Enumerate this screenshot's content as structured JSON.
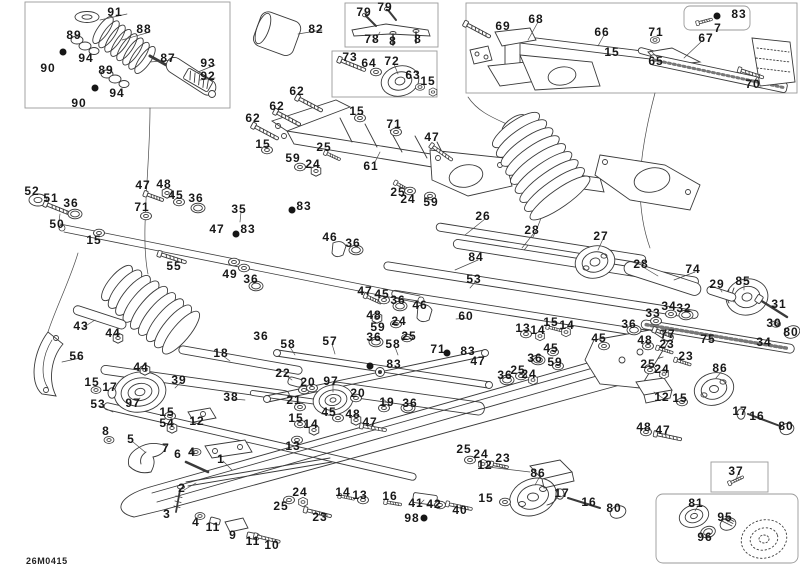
{
  "diagram": {
    "type": "exploded-parts-diagram",
    "drawing_number": "26M0415",
    "colors": {
      "background": "#ffffff",
      "line": "#3a3a3a",
      "box_border": "#9a9a9a",
      "label": "#181818"
    },
    "labels": [
      {
        "t": "91",
        "x": 115,
        "y": 12
      },
      {
        "t": "88",
        "x": 144,
        "y": 29
      },
      {
        "t": "89",
        "x": 74,
        "y": 35
      },
      {
        "t": "94",
        "x": 86,
        "y": 58
      },
      {
        "t": "90",
        "x": 48,
        "y": 68
      },
      {
        "t": "87",
        "x": 168,
        "y": 58
      },
      {
        "t": "93",
        "x": 208,
        "y": 63
      },
      {
        "t": "92",
        "x": 208,
        "y": 76
      },
      {
        "t": "89",
        "x": 106,
        "y": 70
      },
      {
        "t": "94",
        "x": 117,
        "y": 93
      },
      {
        "t": "90",
        "x": 79,
        "y": 103
      },
      {
        "t": "82",
        "x": 316,
        "y": 29
      },
      {
        "t": "79",
        "x": 364,
        "y": 12
      },
      {
        "t": "79",
        "x": 385,
        "y": 7
      },
      {
        "t": "78",
        "x": 372,
        "y": 39
      },
      {
        "t": "8",
        "x": 393,
        "y": 41
      },
      {
        "t": "8",
        "x": 418,
        "y": 39
      },
      {
        "t": "73",
        "x": 350,
        "y": 57
      },
      {
        "t": "64",
        "x": 369,
        "y": 63
      },
      {
        "t": "72",
        "x": 392,
        "y": 61
      },
      {
        "t": "63",
        "x": 413,
        "y": 75
      },
      {
        "t": "15",
        "x": 428,
        "y": 81
      },
      {
        "t": "62",
        "x": 297,
        "y": 91
      },
      {
        "t": "62",
        "x": 277,
        "y": 106
      },
      {
        "t": "62",
        "x": 253,
        "y": 118
      },
      {
        "t": "15",
        "x": 357,
        "y": 111
      },
      {
        "t": "15",
        "x": 263,
        "y": 144
      },
      {
        "t": "69",
        "x": 503,
        "y": 26
      },
      {
        "t": "68",
        "x": 536,
        "y": 19
      },
      {
        "t": "66",
        "x": 602,
        "y": 32
      },
      {
        "t": "71",
        "x": 656,
        "y": 32
      },
      {
        "t": "83",
        "x": 739,
        "y": 14
      },
      {
        "t": "7",
        "x": 718,
        "y": 28
      },
      {
        "t": "67",
        "x": 706,
        "y": 38
      },
      {
        "t": "15",
        "x": 612,
        "y": 52
      },
      {
        "t": "65",
        "x": 656,
        "y": 61
      },
      {
        "t": "70",
        "x": 753,
        "y": 84
      },
      {
        "t": "52",
        "x": 32,
        "y": 191
      },
      {
        "t": "51",
        "x": 51,
        "y": 198
      },
      {
        "t": "36",
        "x": 71,
        "y": 203
      },
      {
        "t": "50",
        "x": 57,
        "y": 224
      },
      {
        "t": "15",
        "x": 94,
        "y": 240
      },
      {
        "t": "47",
        "x": 143,
        "y": 185
      },
      {
        "t": "48",
        "x": 164,
        "y": 184
      },
      {
        "t": "45",
        "x": 176,
        "y": 195
      },
      {
        "t": "36",
        "x": 196,
        "y": 198
      },
      {
        "t": "71",
        "x": 142,
        "y": 207
      },
      {
        "t": "35",
        "x": 239,
        "y": 209
      },
      {
        "t": "47",
        "x": 217,
        "y": 229
      },
      {
        "t": "83",
        "x": 248,
        "y": 229
      },
      {
        "t": "55",
        "x": 174,
        "y": 266
      },
      {
        "t": "49",
        "x": 230,
        "y": 274
      },
      {
        "t": "36",
        "x": 251,
        "y": 279
      },
      {
        "t": "25",
        "x": 324,
        "y": 147
      },
      {
        "t": "59",
        "x": 293,
        "y": 158
      },
      {
        "t": "24",
        "x": 313,
        "y": 164
      },
      {
        "t": "61",
        "x": 371,
        "y": 166
      },
      {
        "t": "71",
        "x": 394,
        "y": 124
      },
      {
        "t": "47",
        "x": 432,
        "y": 137
      },
      {
        "t": "83",
        "x": 304,
        "y": 206
      },
      {
        "t": "25",
        "x": 398,
        "y": 192
      },
      {
        "t": "24",
        "x": 408,
        "y": 199
      },
      {
        "t": "59",
        "x": 431,
        "y": 202
      },
      {
        "t": "46",
        "x": 330,
        "y": 237
      },
      {
        "t": "36",
        "x": 353,
        "y": 243
      },
      {
        "t": "26",
        "x": 483,
        "y": 216
      },
      {
        "t": "28",
        "x": 532,
        "y": 230
      },
      {
        "t": "27",
        "x": 601,
        "y": 236
      },
      {
        "t": "84",
        "x": 476,
        "y": 257
      },
      {
        "t": "28",
        "x": 641,
        "y": 264
      },
      {
        "t": "74",
        "x": 693,
        "y": 269
      },
      {
        "t": "29",
        "x": 717,
        "y": 284
      },
      {
        "t": "85",
        "x": 743,
        "y": 281
      },
      {
        "t": "31",
        "x": 779,
        "y": 304
      },
      {
        "t": "30",
        "x": 774,
        "y": 323
      },
      {
        "t": "80",
        "x": 791,
        "y": 332
      },
      {
        "t": "34",
        "x": 669,
        "y": 306
      },
      {
        "t": "32",
        "x": 684,
        "y": 308
      },
      {
        "t": "33",
        "x": 653,
        "y": 313
      },
      {
        "t": "36",
        "x": 629,
        "y": 324
      },
      {
        "t": "77",
        "x": 668,
        "y": 334
      },
      {
        "t": "75",
        "x": 708,
        "y": 339
      },
      {
        "t": "34",
        "x": 764,
        "y": 342
      },
      {
        "t": "48",
        "x": 645,
        "y": 340
      },
      {
        "t": "23",
        "x": 667,
        "y": 344
      },
      {
        "t": "23",
        "x": 686,
        "y": 356
      },
      {
        "t": "25",
        "x": 648,
        "y": 364
      },
      {
        "t": "24",
        "x": 662,
        "y": 369
      },
      {
        "t": "86",
        "x": 720,
        "y": 368
      },
      {
        "t": "12",
        "x": 662,
        "y": 397
      },
      {
        "t": "15",
        "x": 680,
        "y": 398
      },
      {
        "t": "17",
        "x": 740,
        "y": 411
      },
      {
        "t": "16",
        "x": 757,
        "y": 416
      },
      {
        "t": "80",
        "x": 786,
        "y": 426
      },
      {
        "t": "48",
        "x": 644,
        "y": 427
      },
      {
        "t": "47",
        "x": 663,
        "y": 430
      },
      {
        "t": "53",
        "x": 474,
        "y": 279
      },
      {
        "t": "47",
        "x": 365,
        "y": 291
      },
      {
        "t": "45",
        "x": 382,
        "y": 294
      },
      {
        "t": "36",
        "x": 398,
        "y": 300
      },
      {
        "t": "46",
        "x": 420,
        "y": 305
      },
      {
        "t": "60",
        "x": 466,
        "y": 316
      },
      {
        "t": "48",
        "x": 374,
        "y": 315
      },
      {
        "t": "24",
        "x": 399,
        "y": 321
      },
      {
        "t": "59",
        "x": 378,
        "y": 327
      },
      {
        "t": "25",
        "x": 409,
        "y": 336
      },
      {
        "t": "36",
        "x": 261,
        "y": 336
      },
      {
        "t": "58",
        "x": 288,
        "y": 344
      },
      {
        "t": "57",
        "x": 330,
        "y": 341
      },
      {
        "t": "36",
        "x": 374,
        "y": 337
      },
      {
        "t": "58",
        "x": 393,
        "y": 344
      },
      {
        "t": "71",
        "x": 438,
        "y": 349
      },
      {
        "t": "83",
        "x": 468,
        "y": 351
      },
      {
        "t": "83",
        "x": 394,
        "y": 364
      },
      {
        "t": "47",
        "x": 478,
        "y": 361
      },
      {
        "t": "22",
        "x": 283,
        "y": 373
      },
      {
        "t": "20",
        "x": 308,
        "y": 382
      },
      {
        "t": "97",
        "x": 331,
        "y": 381
      },
      {
        "t": "21",
        "x": 294,
        "y": 400
      },
      {
        "t": "20",
        "x": 358,
        "y": 393
      },
      {
        "t": "19",
        "x": 387,
        "y": 402
      },
      {
        "t": "36",
        "x": 410,
        "y": 403
      },
      {
        "t": "45",
        "x": 329,
        "y": 412
      },
      {
        "t": "48",
        "x": 353,
        "y": 414
      },
      {
        "t": "47",
        "x": 370,
        "y": 422
      },
      {
        "t": "15",
        "x": 296,
        "y": 418
      },
      {
        "t": "14",
        "x": 311,
        "y": 424
      },
      {
        "t": "13",
        "x": 293,
        "y": 446
      },
      {
        "t": "13",
        "x": 523,
        "y": 328
      },
      {
        "t": "14",
        "x": 538,
        "y": 330
      },
      {
        "t": "15",
        "x": 551,
        "y": 322
      },
      {
        "t": "14",
        "x": 567,
        "y": 325
      },
      {
        "t": "45",
        "x": 599,
        "y": 338
      },
      {
        "t": "45",
        "x": 551,
        "y": 348
      },
      {
        "t": "36",
        "x": 535,
        "y": 358
      },
      {
        "t": "59",
        "x": 555,
        "y": 362
      },
      {
        "t": "25",
        "x": 518,
        "y": 370
      },
      {
        "t": "24",
        "x": 529,
        "y": 374
      },
      {
        "t": "36",
        "x": 505,
        "y": 375
      },
      {
        "t": "43",
        "x": 81,
        "y": 326
      },
      {
        "t": "44",
        "x": 113,
        "y": 333
      },
      {
        "t": "56",
        "x": 77,
        "y": 356
      },
      {
        "t": "44",
        "x": 141,
        "y": 367
      },
      {
        "t": "15",
        "x": 92,
        "y": 382
      },
      {
        "t": "17",
        "x": 110,
        "y": 387
      },
      {
        "t": "39",
        "x": 179,
        "y": 380
      },
      {
        "t": "18",
        "x": 221,
        "y": 353
      },
      {
        "t": "97",
        "x": 133,
        "y": 403
      },
      {
        "t": "53",
        "x": 98,
        "y": 404
      },
      {
        "t": "38",
        "x": 231,
        "y": 397
      },
      {
        "t": "15",
        "x": 167,
        "y": 412
      },
      {
        "t": "12",
        "x": 197,
        "y": 421
      },
      {
        "t": "54",
        "x": 167,
        "y": 423
      },
      {
        "t": "8",
        "x": 106,
        "y": 431
      },
      {
        "t": "5",
        "x": 131,
        "y": 439
      },
      {
        "t": "7",
        "x": 166,
        "y": 448
      },
      {
        "t": "6",
        "x": 178,
        "y": 454
      },
      {
        "t": "4",
        "x": 192,
        "y": 452
      },
      {
        "t": "1",
        "x": 221,
        "y": 459
      },
      {
        "t": "2",
        "x": 182,
        "y": 488
      },
      {
        "t": "3",
        "x": 167,
        "y": 514
      },
      {
        "t": "4",
        "x": 196,
        "y": 522
      },
      {
        "t": "11",
        "x": 213,
        "y": 527
      },
      {
        "t": "9",
        "x": 233,
        "y": 535
      },
      {
        "t": "11",
        "x": 253,
        "y": 541
      },
      {
        "t": "10",
        "x": 272,
        "y": 545
      },
      {
        "t": "25",
        "x": 281,
        "y": 506
      },
      {
        "t": "24",
        "x": 300,
        "y": 492
      },
      {
        "t": "23",
        "x": 320,
        "y": 517
      },
      {
        "t": "25",
        "x": 464,
        "y": 449
      },
      {
        "t": "24",
        "x": 481,
        "y": 454
      },
      {
        "t": "23",
        "x": 503,
        "y": 458
      },
      {
        "t": "12",
        "x": 485,
        "y": 465
      },
      {
        "t": "15",
        "x": 486,
        "y": 498
      },
      {
        "t": "14",
        "x": 343,
        "y": 492
      },
      {
        "t": "13",
        "x": 360,
        "y": 495
      },
      {
        "t": "16",
        "x": 390,
        "y": 496
      },
      {
        "t": "41",
        "x": 416,
        "y": 503
      },
      {
        "t": "42",
        "x": 434,
        "y": 504
      },
      {
        "t": "40",
        "x": 460,
        "y": 510
      },
      {
        "t": "98",
        "x": 412,
        "y": 518
      },
      {
        "t": "86",
        "x": 538,
        "y": 473
      },
      {
        "t": "17",
        "x": 562,
        "y": 493
      },
      {
        "t": "16",
        "x": 589,
        "y": 502
      },
      {
        "t": "80",
        "x": 614,
        "y": 508
      },
      {
        "t": "37",
        "x": 736,
        "y": 471
      },
      {
        "t": "81",
        "x": 696,
        "y": 503
      },
      {
        "t": "95",
        "x": 725,
        "y": 517
      },
      {
        "t": "96",
        "x": 705,
        "y": 537
      }
    ],
    "black_dot_markers": [
      {
        "x": 63,
        "y": 52
      },
      {
        "x": 95,
        "y": 88
      },
      {
        "x": 717,
        "y": 16
      },
      {
        "x": 236,
        "y": 234
      },
      {
        "x": 292,
        "y": 210
      },
      {
        "x": 447,
        "y": 353
      },
      {
        "x": 370,
        "y": 366
      },
      {
        "x": 424,
        "y": 518
      }
    ]
  }
}
